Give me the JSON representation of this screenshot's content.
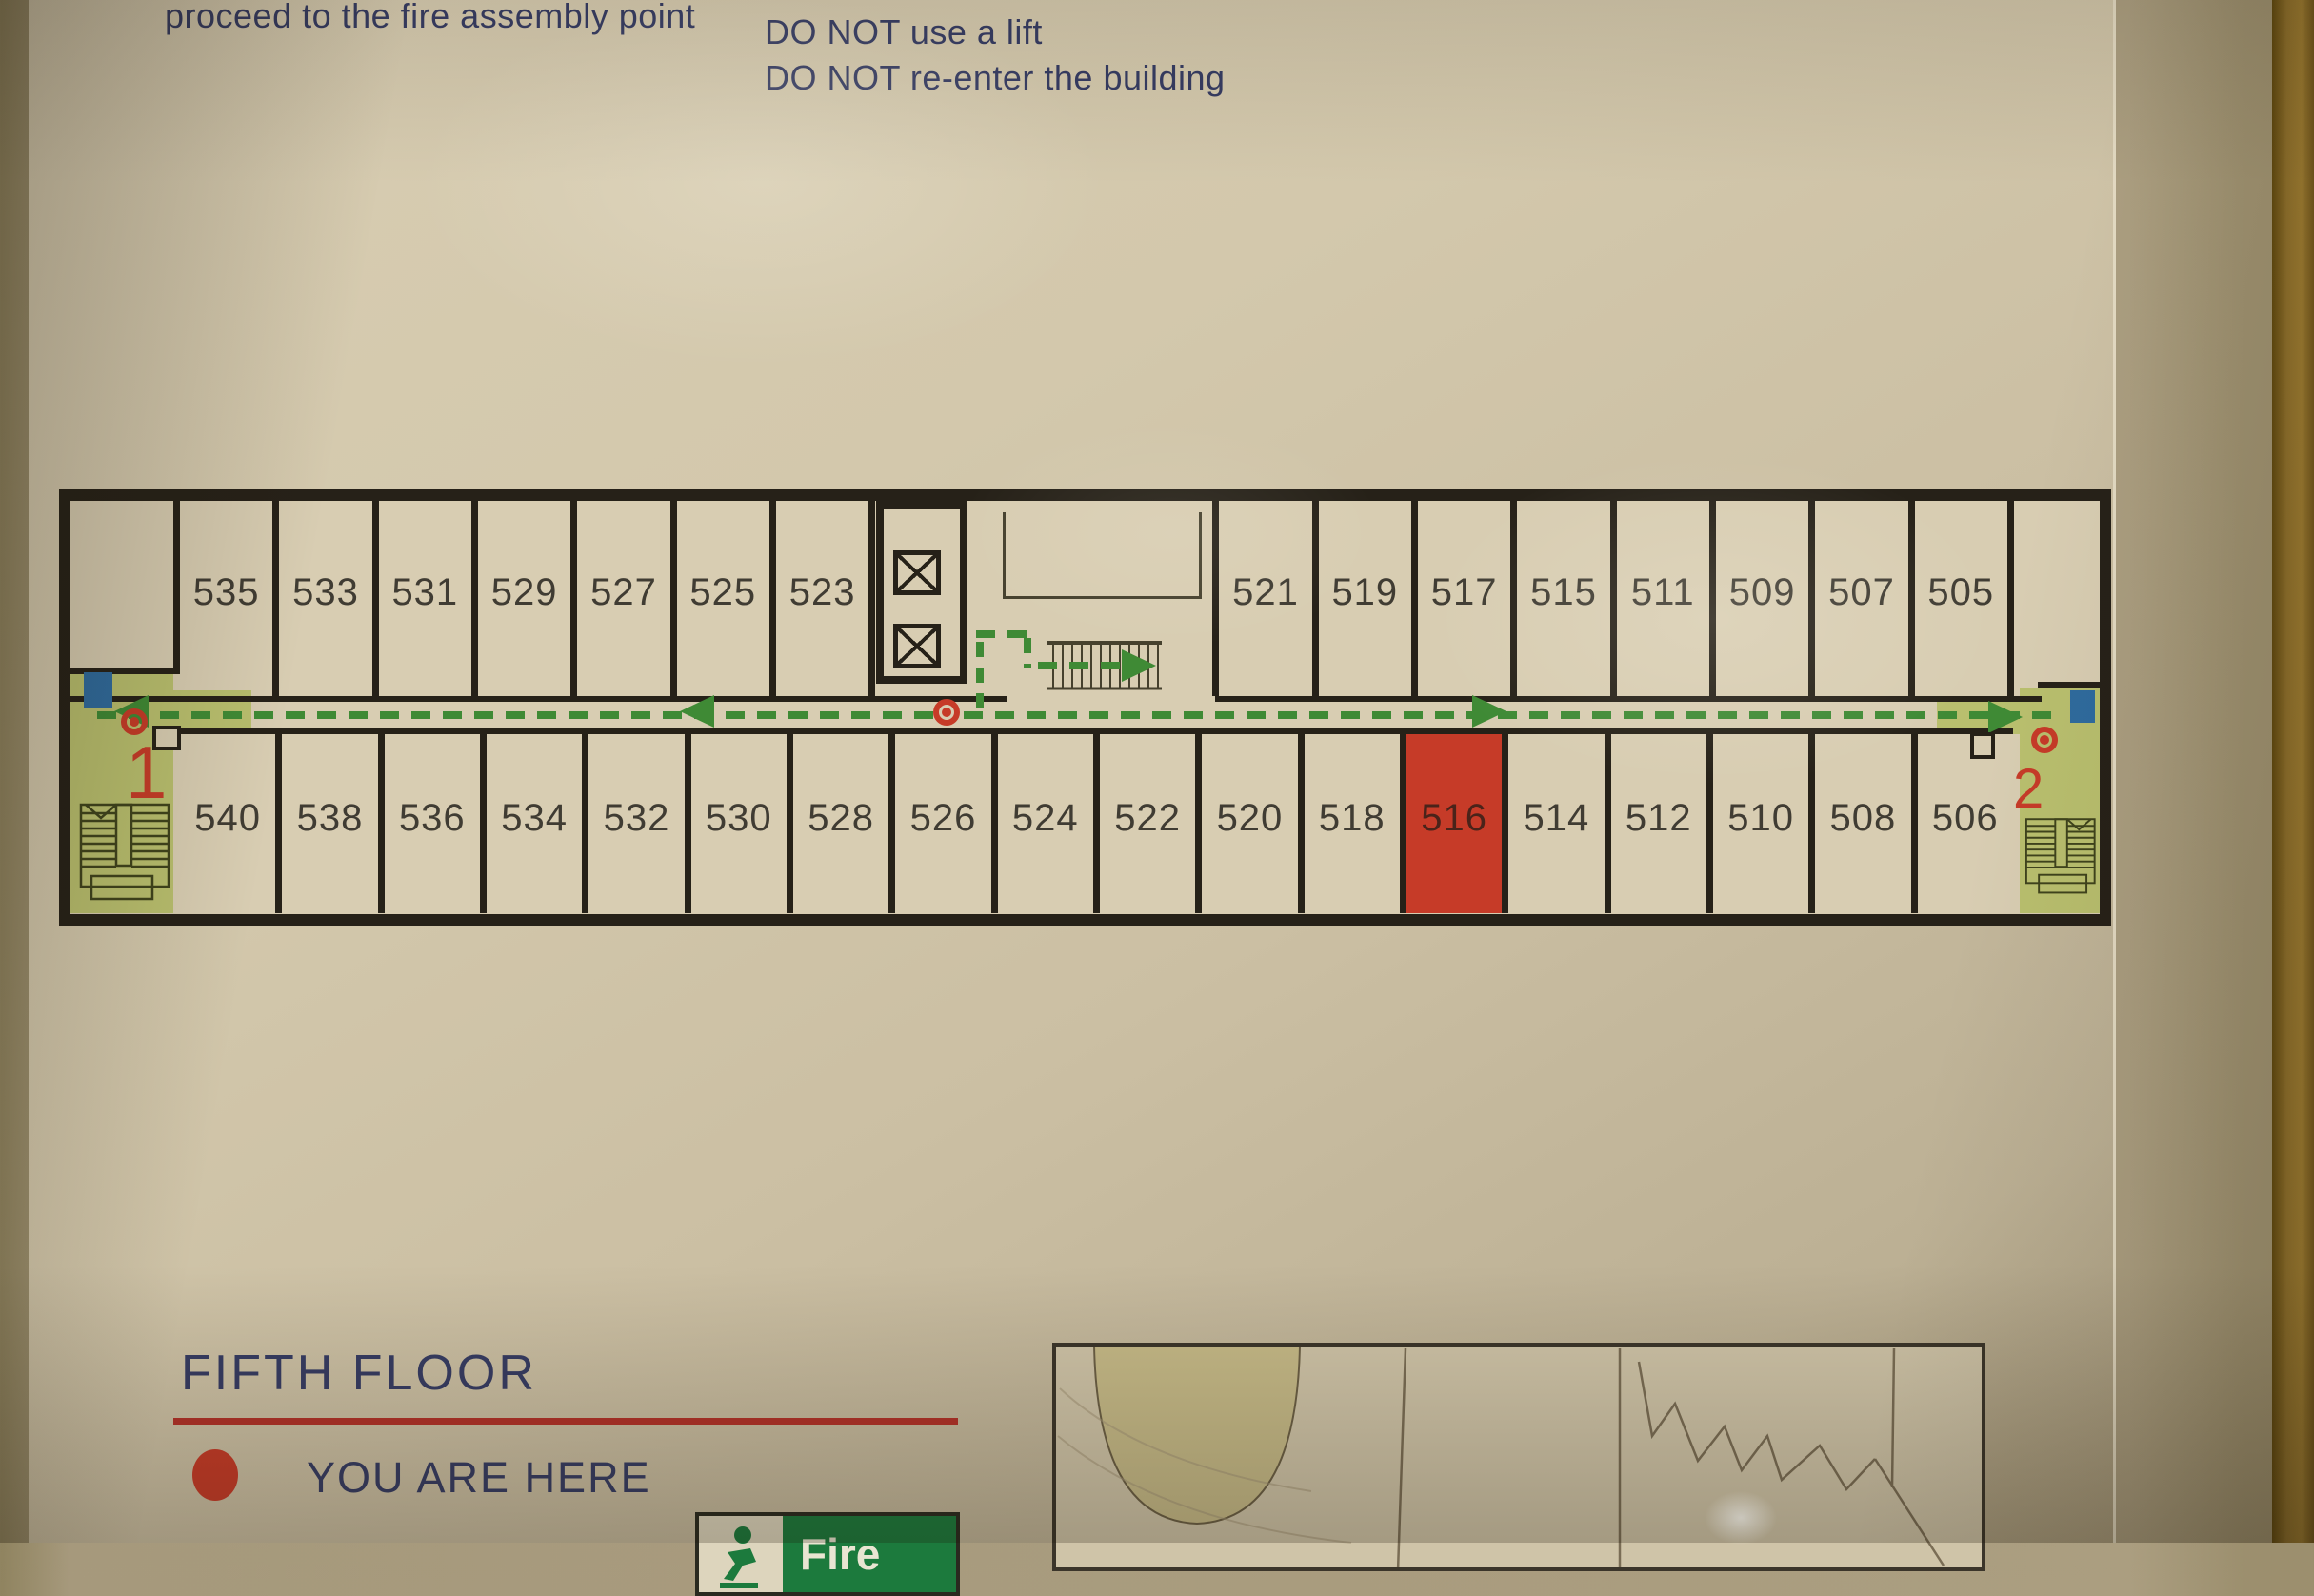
{
  "instructions": {
    "left_partial": "proceed to the fire assembly point",
    "right_line_1": "DO NOT shout or run",
    "right_line_2": "DO NOT use a lift",
    "right_line_3": "DO NOT re-enter the building"
  },
  "plan": {
    "top_rooms_left": [
      "535",
      "533",
      "531",
      "529",
      "527",
      "525",
      "523"
    ],
    "top_rooms_right": [
      "521",
      "519",
      "517",
      "515",
      "511",
      "509",
      "507",
      "505"
    ],
    "bottom_rooms": [
      "540",
      "538",
      "536",
      "534",
      "532",
      "530",
      "528",
      "526",
      "524",
      "522",
      "520",
      "518",
      "516",
      "514",
      "512",
      "510",
      "508",
      "506"
    ],
    "highlighted_room": "516",
    "stair_1_label": "1",
    "stair_2_label": "2"
  },
  "legend": {
    "floor_title": "FIFTH FLOOR",
    "you_are_here_label": "YOU ARE HERE",
    "fire_exit_label": "Fire"
  },
  "colors": {
    "route_green": "#3f8a35",
    "stair_green": "#b9bf6e",
    "alert_red": "#c63b28",
    "text_navy": "#363c63",
    "wall_black": "#262118",
    "refuge_blue": "#2f6b9e"
  }
}
